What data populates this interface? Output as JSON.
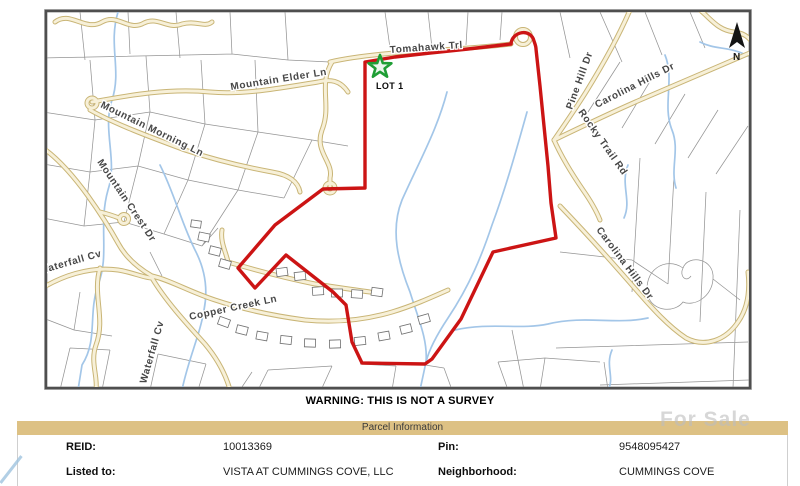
{
  "map": {
    "warning": "WARNING: THIS IS NOT A SURVEY",
    "north_label": "N",
    "lot_label": "LOT 1",
    "labels": [
      {
        "text": "Tomahawk Trl"
      },
      {
        "text": "Mountain Elder Ln"
      },
      {
        "text": "Mountain Morning Ln"
      },
      {
        "text": "Mountain Crest Dr"
      },
      {
        "text": "Waterfall Cv"
      },
      {
        "text": "Waterfall Cv"
      },
      {
        "text": "Copper Creek Ln"
      },
      {
        "text": "Pine Hill Dr"
      },
      {
        "text": "Carolina Hills Dr"
      },
      {
        "text": "Rocky Trail Rd"
      },
      {
        "text": "Carolina Hills Dr"
      }
    ],
    "colors": {
      "boundary_red": "#cc1414",
      "road_fill": "#f7f0d8",
      "road_casing": "#c9b576",
      "stream_blue": "#a3c6e8",
      "star_green": "#1f9e35",
      "header_tan": "#ddc184"
    }
  },
  "watermark": {
    "text": "For Sale"
  },
  "parcel_table": {
    "title": "Parcel Information",
    "fields": [
      {
        "label": "REID:",
        "value": "10013369"
      },
      {
        "label": "Pin:",
        "value": "9548095427"
      },
      {
        "label": "Listed to:",
        "value": "VISTA AT CUMMINGS COVE, LLC"
      },
      {
        "label": "Neighborhood:",
        "value": "CUMMINGS COVE"
      }
    ]
  }
}
